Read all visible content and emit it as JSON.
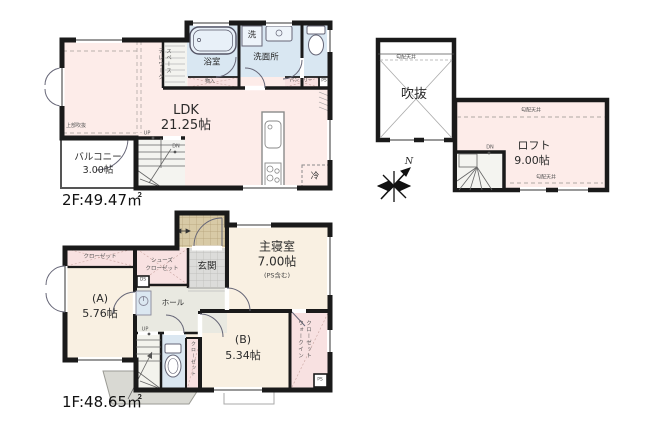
{
  "floor2": {
    "area_label": "2F:49.47㎡",
    "ldk": {
      "name": "LDK",
      "size": "21.25帖"
    },
    "balcony": {
      "name": "バルコニー",
      "size": "3.00帖"
    },
    "bath": "浴室",
    "washer": "洗",
    "washroom": "洗面所",
    "storage": "物入",
    "pantry": "パントリー",
    "pipe_space": "PS",
    "fridge": "冷",
    "stairs": {
      "up": "UP",
      "down": "DN"
    },
    "open_above": "上部吹抜",
    "telework": {
      "line1": "テレワーク",
      "line2": "スペース"
    }
  },
  "loft": {
    "void": "吹抜",
    "loft": {
      "name": "ロフト",
      "size": "9.00帖"
    },
    "sloped_ceiling": "勾配天井",
    "down": "DN",
    "north": "N"
  },
  "floor1": {
    "area_label": "1F:48.65㎡",
    "closet": "クローゼット",
    "shoes_closet": {
      "line1": "シューズ",
      "line2": "クローゼット"
    },
    "entrance": "玄関",
    "master": {
      "name": "主寝室",
      "size": "7.00帖",
      "note": "(PS含む)"
    },
    "room_a": {
      "name": "(A)",
      "size": "5.76帖"
    },
    "hall": "ホール",
    "room_b": {
      "name": "(B)",
      "size": "5.34帖"
    },
    "wic": {
      "line1": "ウォークイン",
      "line2": "クローゼット"
    },
    "closet_b": "クローゼット",
    "duct_space": "DS",
    "pipe_space": "PS",
    "up": "UP"
  },
  "colors": {
    "wall": "#1a1a1a",
    "room_pink": "#fdece9",
    "room_blue": "#d9e7f2",
    "room_cream": "#f9f0e2",
    "closet_pink": "#f8e1e1",
    "hall_gray": "#e9e9e1",
    "porch_tan": "#d8caa6",
    "tile_gray": "#dcdcda"
  }
}
